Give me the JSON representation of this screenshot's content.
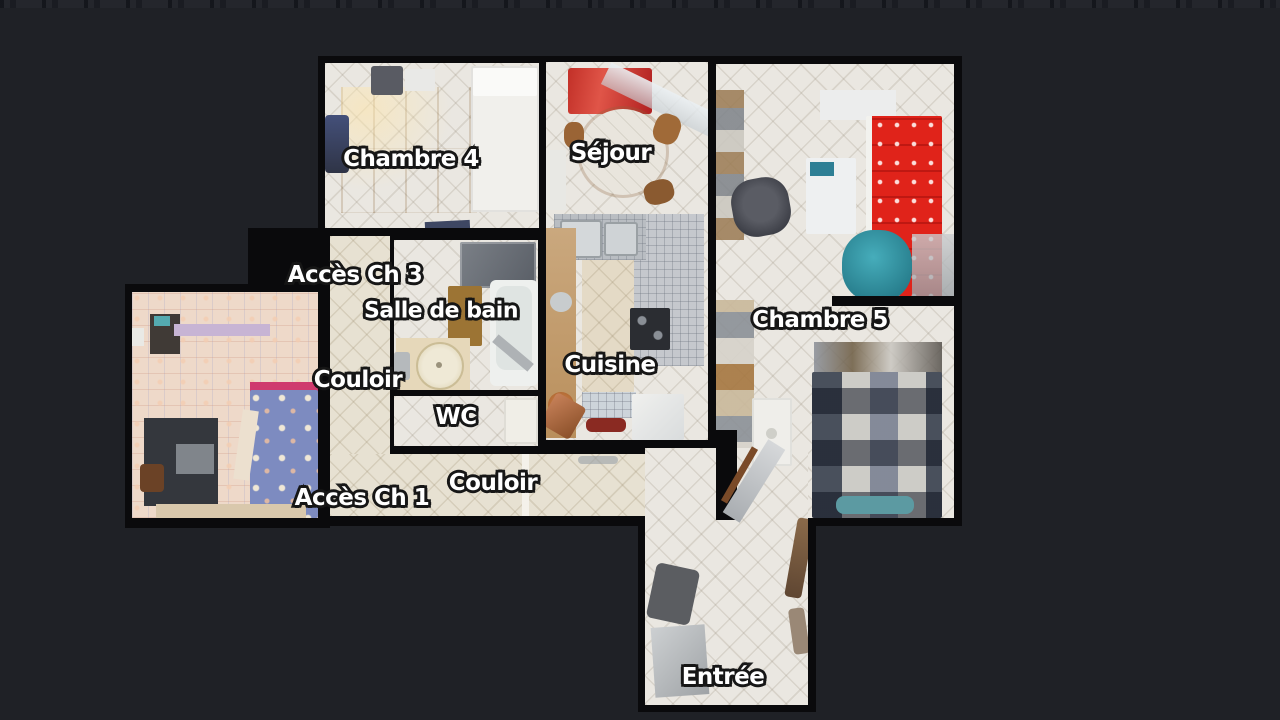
{
  "view": {
    "name": "apartment-floorplan-top-view"
  },
  "theme": {
    "bg": "#1f2126",
    "wall": "#0a0a0c",
    "tile": "#eae7e1",
    "tile-warm": "#e7e1d2",
    "floor-pink": "#eed9c9",
    "accent-red": "#e0231a",
    "accent-teal": "#257a89",
    "bed-blue": "#7d8bc0",
    "label-color": "#ffffff",
    "label-outline": "#161616"
  },
  "floorplan": {
    "labels": [
      {
        "id": "chambre-4",
        "text": "Chambre 4"
      },
      {
        "id": "sejour",
        "text": "Séjour"
      },
      {
        "id": "acces-ch-3",
        "text": "Accès Ch 3"
      },
      {
        "id": "salle-de-bain",
        "text": "Salle de bain"
      },
      {
        "id": "couloir-ouest",
        "text": "Couloir"
      },
      {
        "id": "wc",
        "text": "WC"
      },
      {
        "id": "cuisine",
        "text": "Cuisine"
      },
      {
        "id": "chambre-5",
        "text": "Chambre 5"
      },
      {
        "id": "acces-ch-1",
        "text": "Accès Ch 1"
      },
      {
        "id": "couloir-sud",
        "text": "Couloir"
      },
      {
        "id": "entree",
        "text": "Entrée"
      }
    ]
  }
}
